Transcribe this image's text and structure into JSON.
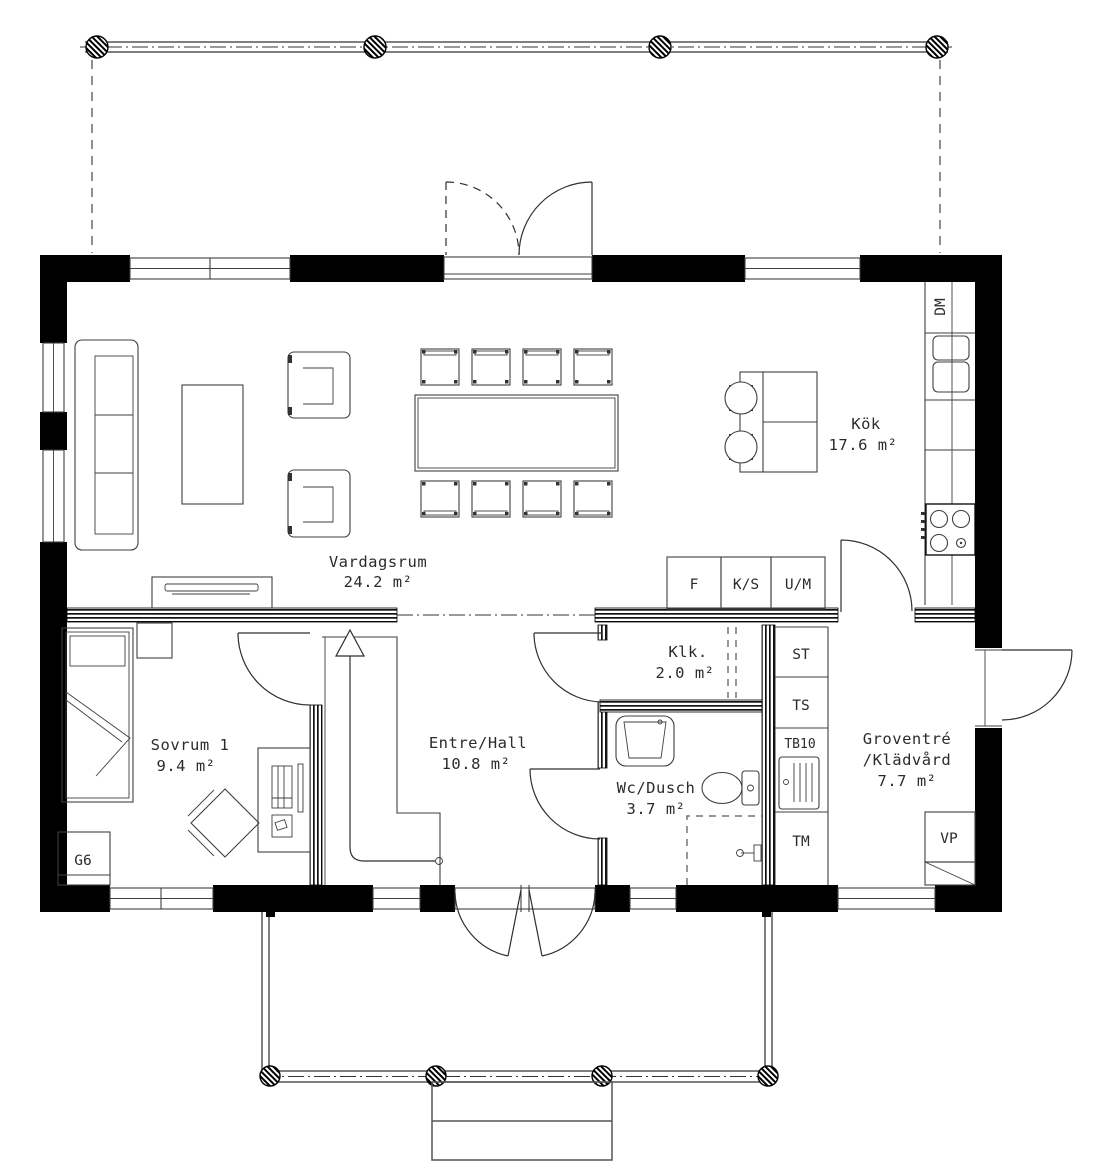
{
  "drawing": {
    "rooms": {
      "vardagsrum": {
        "name": "Vardagsrum",
        "area": "24.2 m²"
      },
      "kok": {
        "name": "Kök",
        "area": "17.6 m²"
      },
      "sovrum1": {
        "name": "Sovrum 1",
        "area": "9.4 m²"
      },
      "entre": {
        "name": "Entre/Hall",
        "area": "10.8 m²"
      },
      "klk": {
        "name": "Klk.",
        "area": "2.0 m²"
      },
      "wc": {
        "name": "Wc/Dusch",
        "area": "3.7 m²"
      },
      "groventre": {
        "name": "Groventré",
        "name2": "/Klädvård",
        "area": "7.7 m²"
      }
    },
    "cabinets": {
      "dishwasher": "DM",
      "fridge": "F",
      "cool_store": "K/S",
      "oven_micro": "U/M",
      "st": "ST",
      "ts": "TS",
      "tb10": "TB10",
      "tumble_dryer": "TM",
      "wardrobe": "G6",
      "heat_pump": "VP"
    },
    "colors": {
      "wall": "#000000",
      "line": "#3f3f3f",
      "text": "#2b2b2b",
      "background": "#ffffff"
    }
  }
}
